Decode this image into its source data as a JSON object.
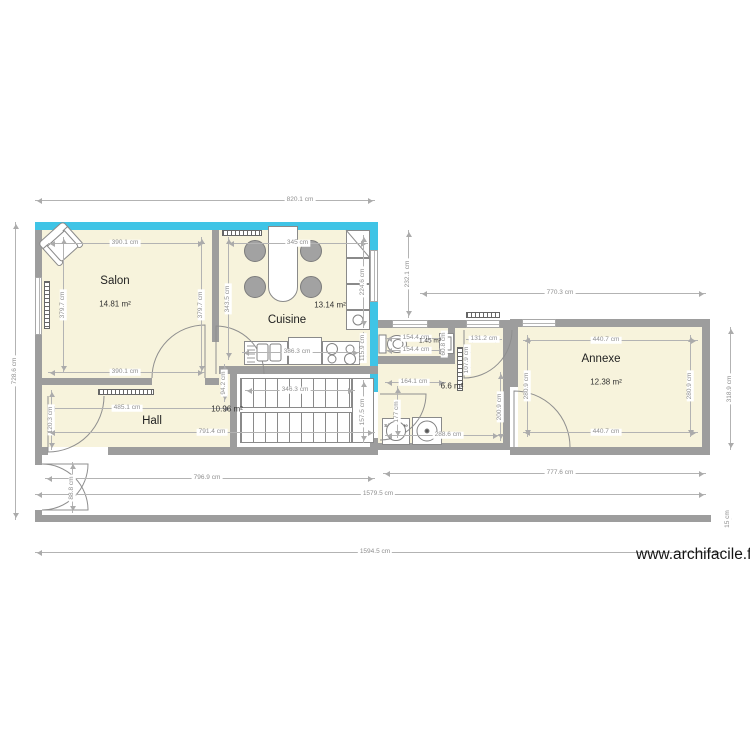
{
  "watermark": "www.archifacile.fr",
  "colors": {
    "wall": "#9d9d9d",
    "accent_wall": "#3fc4e6",
    "floor": "#f7f3dc",
    "dimension": "#8f8f8f"
  },
  "rooms": {
    "salon": {
      "name": "Salon",
      "area": "14.81 m²"
    },
    "cuisine": {
      "name": "Cuisine",
      "area": "13.14 m²"
    },
    "hall": {
      "name": "Hall",
      "area": "10.96 m²"
    },
    "annexe": {
      "name": "Annexe",
      "area": "12.38 m²"
    },
    "wc": {
      "area": "1.45 m²"
    },
    "buanderie": {
      "area": "6.6 m²"
    }
  },
  "appliances": {
    "dryer_label": "Sèche linge"
  },
  "dimensions": [
    {
      "label": "820.1 cm",
      "x1": 35,
      "y1": 200,
      "x2": 375,
      "y2": 200,
      "lx": 300
    },
    {
      "label": "728.6 cm",
      "x1": 15,
      "y1": 222,
      "x2": 15,
      "y2": 520
    },
    {
      "label": "390.1 cm",
      "x1": 48,
      "y1": 243,
      "x2": 205,
      "y2": 243,
      "lx": 125
    },
    {
      "label": "345 cm",
      "x1": 227,
      "y1": 243,
      "x2": 368,
      "y2": 243
    },
    {
      "label": "379.7 cm",
      "x1": 63,
      "y1": 237,
      "x2": 63,
      "y2": 373
    },
    {
      "label": "379.7 cm",
      "x1": 201,
      "y1": 237,
      "x2": 201,
      "y2": 373
    },
    {
      "label": "343.5 cm",
      "x1": 228,
      "y1": 237,
      "x2": 228,
      "y2": 360
    },
    {
      "label": "390.1 cm",
      "x1": 48,
      "y1": 372,
      "x2": 205,
      "y2": 372,
      "lx": 125
    },
    {
      "label": "224.6 cm",
      "x1": 363,
      "y1": 235,
      "x2": 363,
      "y2": 328
    },
    {
      "label": "115.9 cm",
      "x1": 363,
      "y1": 332,
      "x2": 363,
      "y2": 363
    },
    {
      "label": "232.1 cm",
      "x1": 408,
      "y1": 230,
      "x2": 408,
      "y2": 318
    },
    {
      "label": "770.3 cm",
      "x1": 420,
      "y1": 293,
      "x2": 706,
      "y2": 293,
      "lx": 560
    },
    {
      "label": "386.3 cm",
      "x1": 242,
      "y1": 352,
      "x2": 360,
      "y2": 352,
      "lx": 297
    },
    {
      "label": "94.2 cm",
      "x1": 224,
      "y1": 364,
      "x2": 224,
      "y2": 402
    },
    {
      "label": "346.3 cm",
      "x1": 245,
      "y1": 390,
      "x2": 355,
      "y2": 390,
      "lx": 295
    },
    {
      "label": "157.5 cm",
      "x1": 363,
      "y1": 380,
      "x2": 363,
      "y2": 443
    },
    {
      "label": "154.4 cm",
      "x1": 385,
      "y1": 338,
      "x2": 446,
      "y2": 338,
      "lx": 416
    },
    {
      "label": "154.4 cm",
      "x1": 385,
      "y1": 350,
      "x2": 446,
      "y2": 350,
      "lx": 416
    },
    {
      "label": "60.8 cm",
      "x1": 444,
      "y1": 332,
      "x2": 444,
      "y2": 356
    },
    {
      "label": "131.2 cm",
      "x1": 466,
      "y1": 339,
      "x2": 502,
      "y2": 339
    },
    {
      "label": "107.9 cm",
      "x1": 467,
      "y1": 346,
      "x2": 467,
      "y2": 374
    },
    {
      "label": "164.1 cm",
      "x1": 385,
      "y1": 382,
      "x2": 446,
      "y2": 382,
      "lx": 414
    },
    {
      "label": "177 cm",
      "x1": 397,
      "y1": 386,
      "x2": 397,
      "y2": 438
    },
    {
      "label": "288.6 cm",
      "x1": 385,
      "y1": 435,
      "x2": 500,
      "y2": 435,
      "lx": 448
    },
    {
      "label": "200.9 cm",
      "x1": 500,
      "y1": 372,
      "x2": 500,
      "y2": 441
    },
    {
      "label": "440.7 cm",
      "x1": 523,
      "y1": 340,
      "x2": 698,
      "y2": 340,
      "lx": 606
    },
    {
      "label": "440.7 cm",
      "x1": 523,
      "y1": 432,
      "x2": 698,
      "y2": 432,
      "lx": 606
    },
    {
      "label": "280.9 cm",
      "x1": 527,
      "y1": 335,
      "x2": 527,
      "y2": 437
    },
    {
      "label": "280.9 cm",
      "x1": 690,
      "y1": 335,
      "x2": 690,
      "y2": 437
    },
    {
      "label": "318.9 cm",
      "x1": 730,
      "y1": 327,
      "x2": 730,
      "y2": 450
    },
    {
      "label": "485.1 cm",
      "x1": 48,
      "y1": 408,
      "x2": 232,
      "y2": 408,
      "lx": 127
    },
    {
      "label": "120.3 cm",
      "x1": 51,
      "y1": 390,
      "x2": 51,
      "y2": 450
    },
    {
      "label": "791.4 cm",
      "x1": 48,
      "y1": 432,
      "x2": 375,
      "y2": 432,
      "lx": 212
    },
    {
      "label": "796.9 cm",
      "x1": 45,
      "y1": 478,
      "x2": 375,
      "y2": 478,
      "lx": 207
    },
    {
      "label": "777.6 cm",
      "x1": 383,
      "y1": 473,
      "x2": 706,
      "y2": 473,
      "lx": 560
    },
    {
      "label": "1579.5 cm",
      "x1": 35,
      "y1": 494,
      "x2": 706,
      "y2": 494,
      "lx": 378
    },
    {
      "label": "1594.5 cm",
      "x1": 35,
      "y1": 552,
      "x2": 722,
      "y2": 552,
      "lx": 375
    },
    {
      "label": "88.8 cm",
      "x1": 72,
      "y1": 462,
      "x2": 72,
      "y2": 513
    },
    {
      "label": "15 cm",
      "x1": 728,
      "y1": 512,
      "x2": 728,
      "y2": 526
    }
  ]
}
